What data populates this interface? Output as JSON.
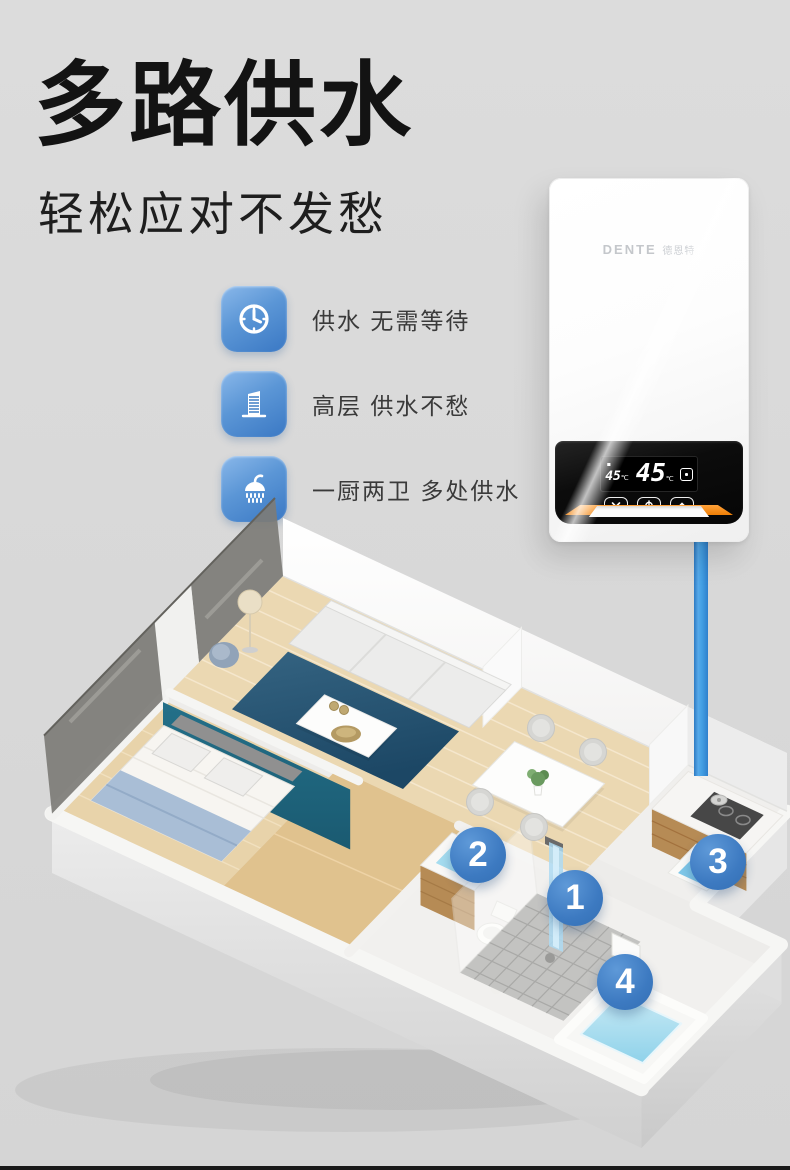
{
  "page": {
    "background": "#d9d9d9",
    "bottom_bar_color": "#191919"
  },
  "header": {
    "title": "多路供水",
    "subtitle": "轻松应对不发愁"
  },
  "features": [
    {
      "icon": "clock-icon",
      "label": "供水 无需等待"
    },
    {
      "icon": "building-icon",
      "label": "高层 供水不愁"
    },
    {
      "icon": "shower-icon",
      "label": "一厨两卫 多处供水"
    }
  ],
  "feature_icon_colors": {
    "start": "#8ab8ea",
    "end": "#3a78c4"
  },
  "heater": {
    "brand": "DENTE",
    "brand_cn": "德恩特",
    "display": {
      "set_temp": "45",
      "set_unit": "℃",
      "temp": "45",
      "unit": "℃",
      "mode_icon": "heat-mode-icon"
    },
    "buttons": [
      {
        "icon": "chevron-down-icon"
      },
      {
        "icon": "power-icon"
      },
      {
        "icon": "chevron-up-icon"
      }
    ],
    "accent_color": "#ee7e06",
    "panel_color": "#0c0c0c"
  },
  "pipe": {
    "color": "#44a0e4"
  },
  "floorplan": {
    "marker_color": "#3d7ac1",
    "markers": [
      {
        "number": "1",
        "location": "shower"
      },
      {
        "number": "2",
        "location": "bathroom-basin"
      },
      {
        "number": "3",
        "location": "kitchen-sink"
      },
      {
        "number": "4",
        "location": "bathtub"
      }
    ]
  }
}
